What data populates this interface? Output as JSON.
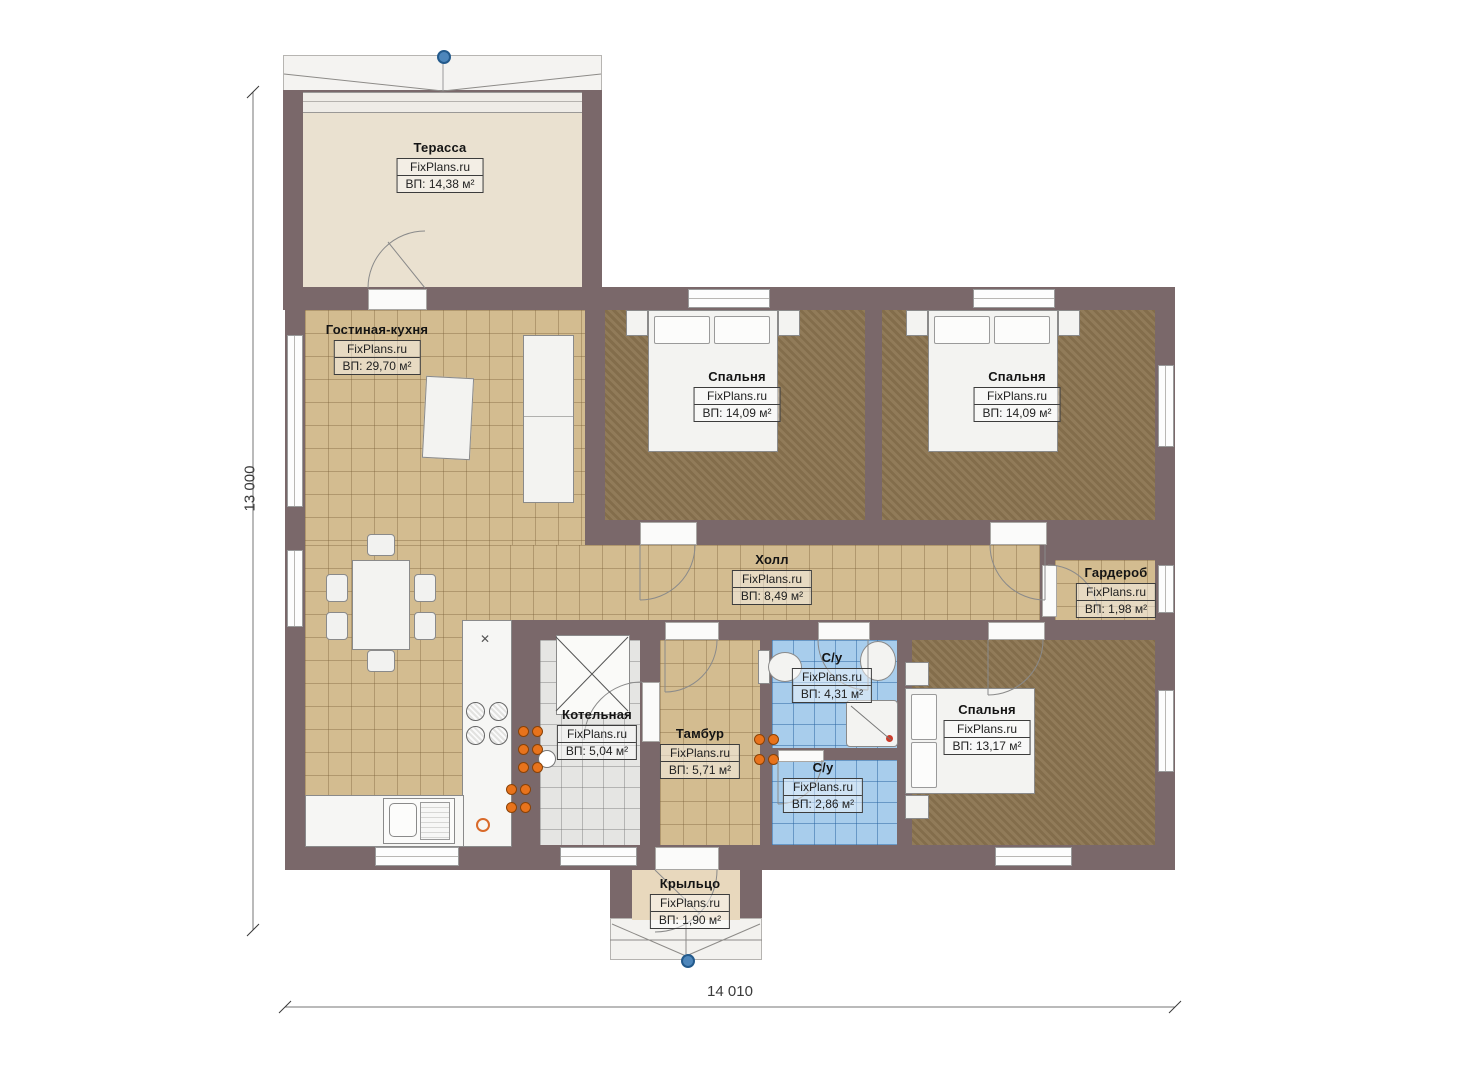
{
  "brand": "FixPlans.ru",
  "dimensions": {
    "left": "13 000",
    "bottom": "14 010"
  },
  "rooms": [
    {
      "name": "Терасса",
      "brand": "FixPlans.ru",
      "area": "ВП: 14,38 м²"
    },
    {
      "name": "Гостиная-кухня",
      "brand": "FixPlans.ru",
      "area": "ВП: 29,70 м²"
    },
    {
      "name": "Спальня",
      "brand": "FixPlans.ru",
      "area": "ВП: 14,09 м²"
    },
    {
      "name": "Спальня",
      "brand": "FixPlans.ru",
      "area": "ВП: 14,09 м²"
    },
    {
      "name": "Холл",
      "brand": "FixPlans.ru",
      "area": "ВП: 8,49 м²"
    },
    {
      "name": "Гардероб",
      "brand": "FixPlans.ru",
      "area": "ВП: 1,98 м²"
    },
    {
      "name": "Котельная",
      "brand": "FixPlans.ru",
      "area": "ВП: 5,04 м²"
    },
    {
      "name": "Тамбур",
      "brand": "FixPlans.ru",
      "area": "ВП: 5,71 м²"
    },
    {
      "name": "С/у",
      "brand": "FixPlans.ru",
      "area": "ВП: 4,31 м²"
    },
    {
      "name": "С/у",
      "brand": "FixPlans.ru",
      "area": "ВП: 2,86 м²"
    },
    {
      "name": "Спальня",
      "brand": "FixPlans.ru",
      "area": "ВП: 13,17 м²"
    },
    {
      "name": "Крыльцо",
      "brand": "FixPlans.ru",
      "area": "ВП: 1,90 м²"
    }
  ],
  "colors": {
    "wall": "#7a686a",
    "tile_tan": "#d3bc90",
    "floor_dark": "#8b7450",
    "tile_blue": "#a8cdec",
    "tile_gray": "#e5e5e3",
    "terrace_floor": "#eae1d0",
    "porch_floor": "#e8d8bd",
    "radiator": "#e8731c",
    "marker": "#3c79b4"
  }
}
